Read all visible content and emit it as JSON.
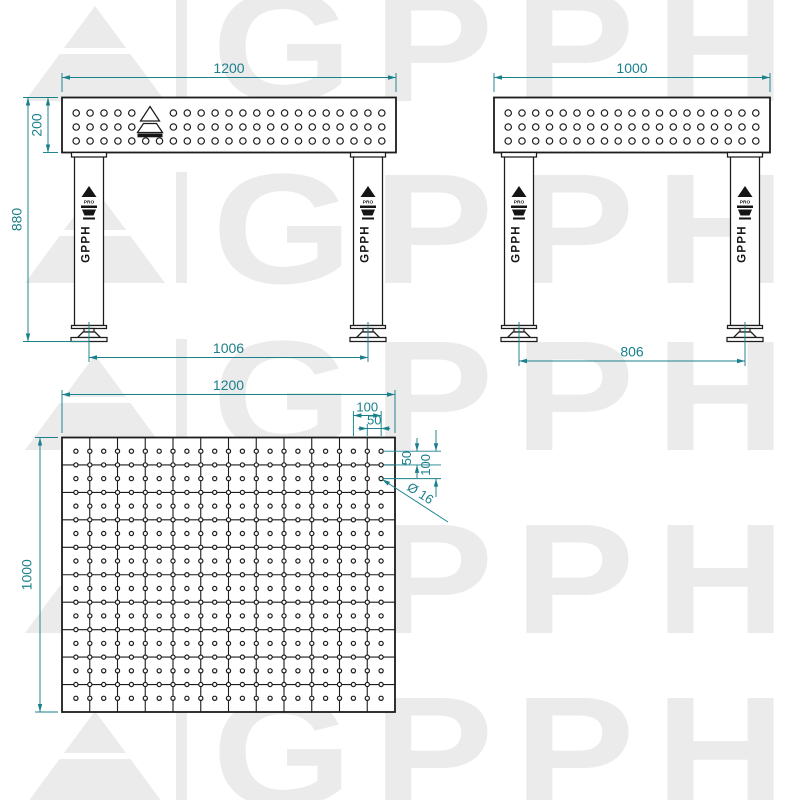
{
  "watermark": {
    "brand_text": "GPPH",
    "color": "#ebebeb"
  },
  "drawing": {
    "colors": {
      "line": "#1c1c1c",
      "dim": "#1a808c",
      "fill": "#ffffff"
    },
    "leg_badge": {
      "series": "PRO",
      "brand": "GPPH"
    },
    "front_view": {
      "width_mm": "1200",
      "surface_height_mm": "200",
      "overall_height_mm": "880",
      "feet_spacing_mm": "1006",
      "hole_cols": 23,
      "hole_rows": 3
    },
    "side_view": {
      "width_mm": "1000",
      "feet_spacing_mm": "806",
      "hole_cols": 19,
      "hole_rows": 3
    },
    "top_view": {
      "width_mm": "1200",
      "depth_mm": "1000",
      "grid_pitch_mm": "100",
      "hole_pitch_mm": "50",
      "edge_row_offset_mm": "50",
      "row_pitch_mm": "100",
      "hole_diameter": "Ø 16",
      "hole_cols": 23,
      "hole_rows": 19,
      "grid_cols": 12,
      "grid_rows": 10
    }
  }
}
